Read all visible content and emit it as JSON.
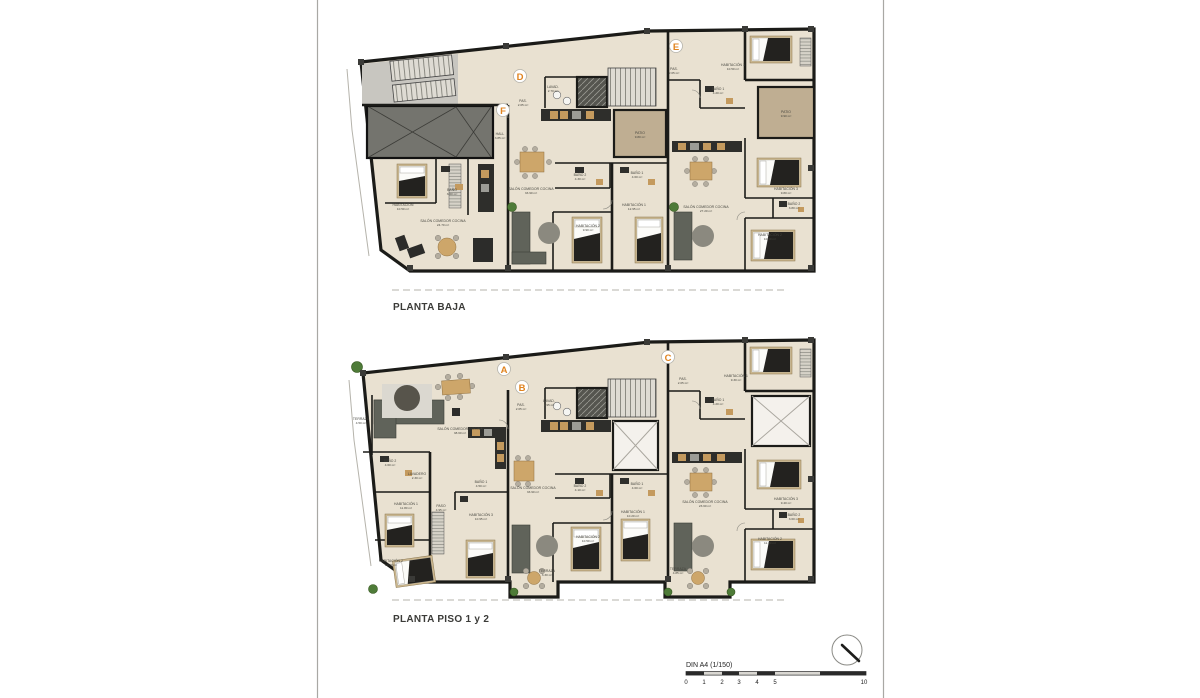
{
  "document": {
    "type": "architectural-floor-plan-sheet",
    "sheet": {
      "background": "#ffffff",
      "border_color": "#a9a8a4"
    }
  },
  "plans": [
    {
      "id": "planta-baja",
      "title": "PLANTA BAJA",
      "units": [
        {
          "letter": "D"
        },
        {
          "letter": "E"
        },
        {
          "letter": "F"
        }
      ],
      "rooms": [
        {
          "name": "HABITACIÓN",
          "area": "10.50 m²"
        },
        {
          "name": "BAÑO",
          "area": "3.60 m²"
        },
        {
          "name": "SALÓN COMEDOR COCINA",
          "area": "24.70 m²"
        },
        {
          "name": "HALL",
          "area": "3.85 m²"
        },
        {
          "name": "PAS.",
          "area": "2.05 m²"
        },
        {
          "name": "LAVAD.",
          "area": "2.70 m²"
        },
        {
          "name": "PATIO",
          "area": "9.80 m²"
        },
        {
          "name": "SALÓN COMEDOR COCINA",
          "area": "33.90 m²"
        },
        {
          "name": "BAÑO 2",
          "area": "4.30 m²"
        },
        {
          "name": "BAÑO 1",
          "area": "4.60 m²"
        },
        {
          "name": "HABITACIÓN 1",
          "area": "12.95 m²"
        },
        {
          "name": "HABITACIÓN 2",
          "area": "9.90 m²"
        },
        {
          "name": "PAS.",
          "area": "2.05 m²"
        },
        {
          "name": "HABITACIÓN 1",
          "area": "10.50 m²"
        },
        {
          "name": "BAÑO 1",
          "area": "4.20 m²"
        },
        {
          "name": "PATIO",
          "area": "9.90 m²"
        },
        {
          "name": "SALÓN COMEDOR COCINA",
          "area": "27.20 m²"
        },
        {
          "name": "HABITACIÓN 3",
          "area": "9.80 m²"
        },
        {
          "name": "BAÑO 2",
          "area": "3.80 m²"
        },
        {
          "name": "HABITACIÓN 2",
          "area": "10.90 m²"
        }
      ]
    },
    {
      "id": "planta-piso-1-2",
      "title": "PLANTA PISO 1 y 2",
      "units": [
        {
          "letter": "A"
        },
        {
          "letter": "B"
        },
        {
          "letter": "C"
        }
      ],
      "rooms": [
        {
          "name": "TERRAZA",
          "area": "4.50 m²"
        },
        {
          "name": "SALÓN COMEDOR COCINA",
          "area": "38.60 m²"
        },
        {
          "name": "BAÑO 2",
          "area": "4.60 m²"
        },
        {
          "name": "LAVADERO",
          "area": "2.30 m²"
        },
        {
          "name": "HABITACIÓN 1",
          "area": "11.80 m²"
        },
        {
          "name": "PASO",
          "area": "4.95 m²"
        },
        {
          "name": "BAÑO 1",
          "area": "4.50 m²"
        },
        {
          "name": "HABITACIÓN 3",
          "area": "10.95 m²"
        },
        {
          "name": "HABITACIÓN 2",
          "area": "10.30 m²"
        },
        {
          "name": "PAS.",
          "area": "2.05 m²"
        },
        {
          "name": "LAVAD.",
          "area": "1.95 m²"
        },
        {
          "name": "SALÓN COMEDOR COCINA",
          "area": "33.90 m²"
        },
        {
          "name": "BAÑO 2",
          "area": "4.10 m²"
        },
        {
          "name": "BAÑO 1",
          "area": "4.60 m²"
        },
        {
          "name": "HABITACIÓN 1",
          "area": "10.20 m²"
        },
        {
          "name": "HABITACIÓN 2",
          "area": "10.50 m²"
        },
        {
          "name": "TERRAZA",
          "area": "3.30 m²"
        },
        {
          "name": "PAS.",
          "area": "2.05 m²"
        },
        {
          "name": "BAÑO 1",
          "area": "4.20 m²"
        },
        {
          "name": "HABITACIÓN 1",
          "area": "9.30 m²"
        },
        {
          "name": "SALÓN COMEDOR COCINA",
          "area": "23.60 m²"
        },
        {
          "name": "HABITACIÓN 3",
          "area": "9.40 m²"
        },
        {
          "name": "BAÑO 2",
          "area": "3.60 m²"
        },
        {
          "name": "HABITACIÓN 2",
          "area": "11.20 m²"
        },
        {
          "name": "TERRAZA",
          "area": "4.85 m²"
        }
      ]
    }
  ],
  "legend": {
    "scale_label": "DIN A4 (1/150)",
    "scale_ticks": [
      "0",
      "1",
      "2",
      "3",
      "4",
      "5",
      "10"
    ]
  },
  "colors": {
    "unit_letter_accent": "#e0831f",
    "wall": "#1b1b18",
    "floor": "#e9e1d1",
    "patio": "#bfae92"
  }
}
